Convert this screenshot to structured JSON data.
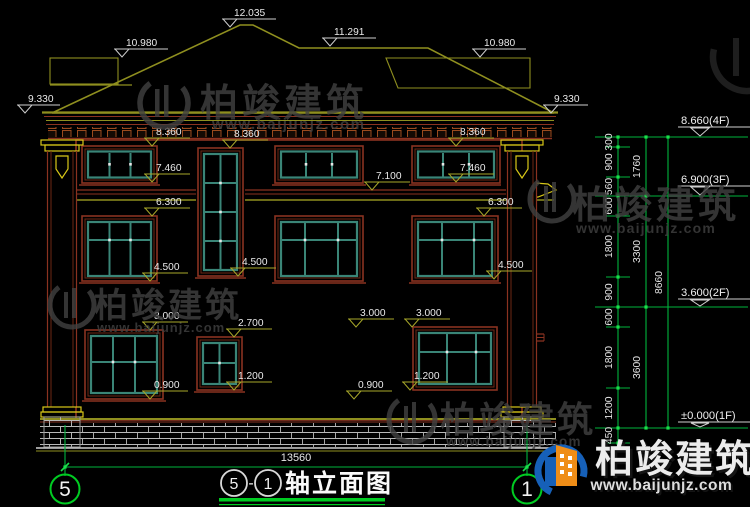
{
  "drawing_title": {
    "axis_start": "5",
    "separator": "-",
    "axis_end": "1",
    "name": "轴立面图"
  },
  "elevation_markers": {
    "roof": [
      "12.035",
      "10.980",
      "11.291",
      "10.980",
      "9.330",
      "9.330"
    ],
    "wall": [
      "8.360",
      "8.360",
      "8.360",
      "7.460",
      "7.460",
      "7.100",
      "6.300",
      "6.300",
      "4.500",
      "4.500",
      "4.500",
      "3.000",
      "3.000",
      "3.000",
      "2.700",
      "1.200",
      "1.200",
      "0.900",
      "0.900"
    ]
  },
  "floor_levels": [
    "8.660(4F)",
    "6.900(3F)",
    "3.600(2F)",
    "±0.000(1F)"
  ],
  "dimensions": {
    "right_segments": [
      "300",
      "900",
      "560",
      "600",
      "1800",
      "900",
      "600",
      "1800",
      "1200",
      "450"
    ],
    "right_floors": [
      "1760",
      "3300",
      "3600"
    ],
    "right_total": "8660",
    "bottom_total": "13560"
  },
  "axis_bubbles": [
    "5",
    "1"
  ],
  "watermark": {
    "brand": "柏竣建筑",
    "url": "www.baijunjz.com"
  },
  "colors": {
    "background": "#000000",
    "dimension_green": "#00b43c",
    "outline_maroon": "#8a3220",
    "trim_olive": "#8f8f1f",
    "accent_yellow": "#d8c818",
    "window_teal": "#3a8577",
    "text_white": "#e8e8e8",
    "logo_blue": "#1660b8",
    "logo_orange": "#ef8d17",
    "watermark_gray": "#414141"
  }
}
